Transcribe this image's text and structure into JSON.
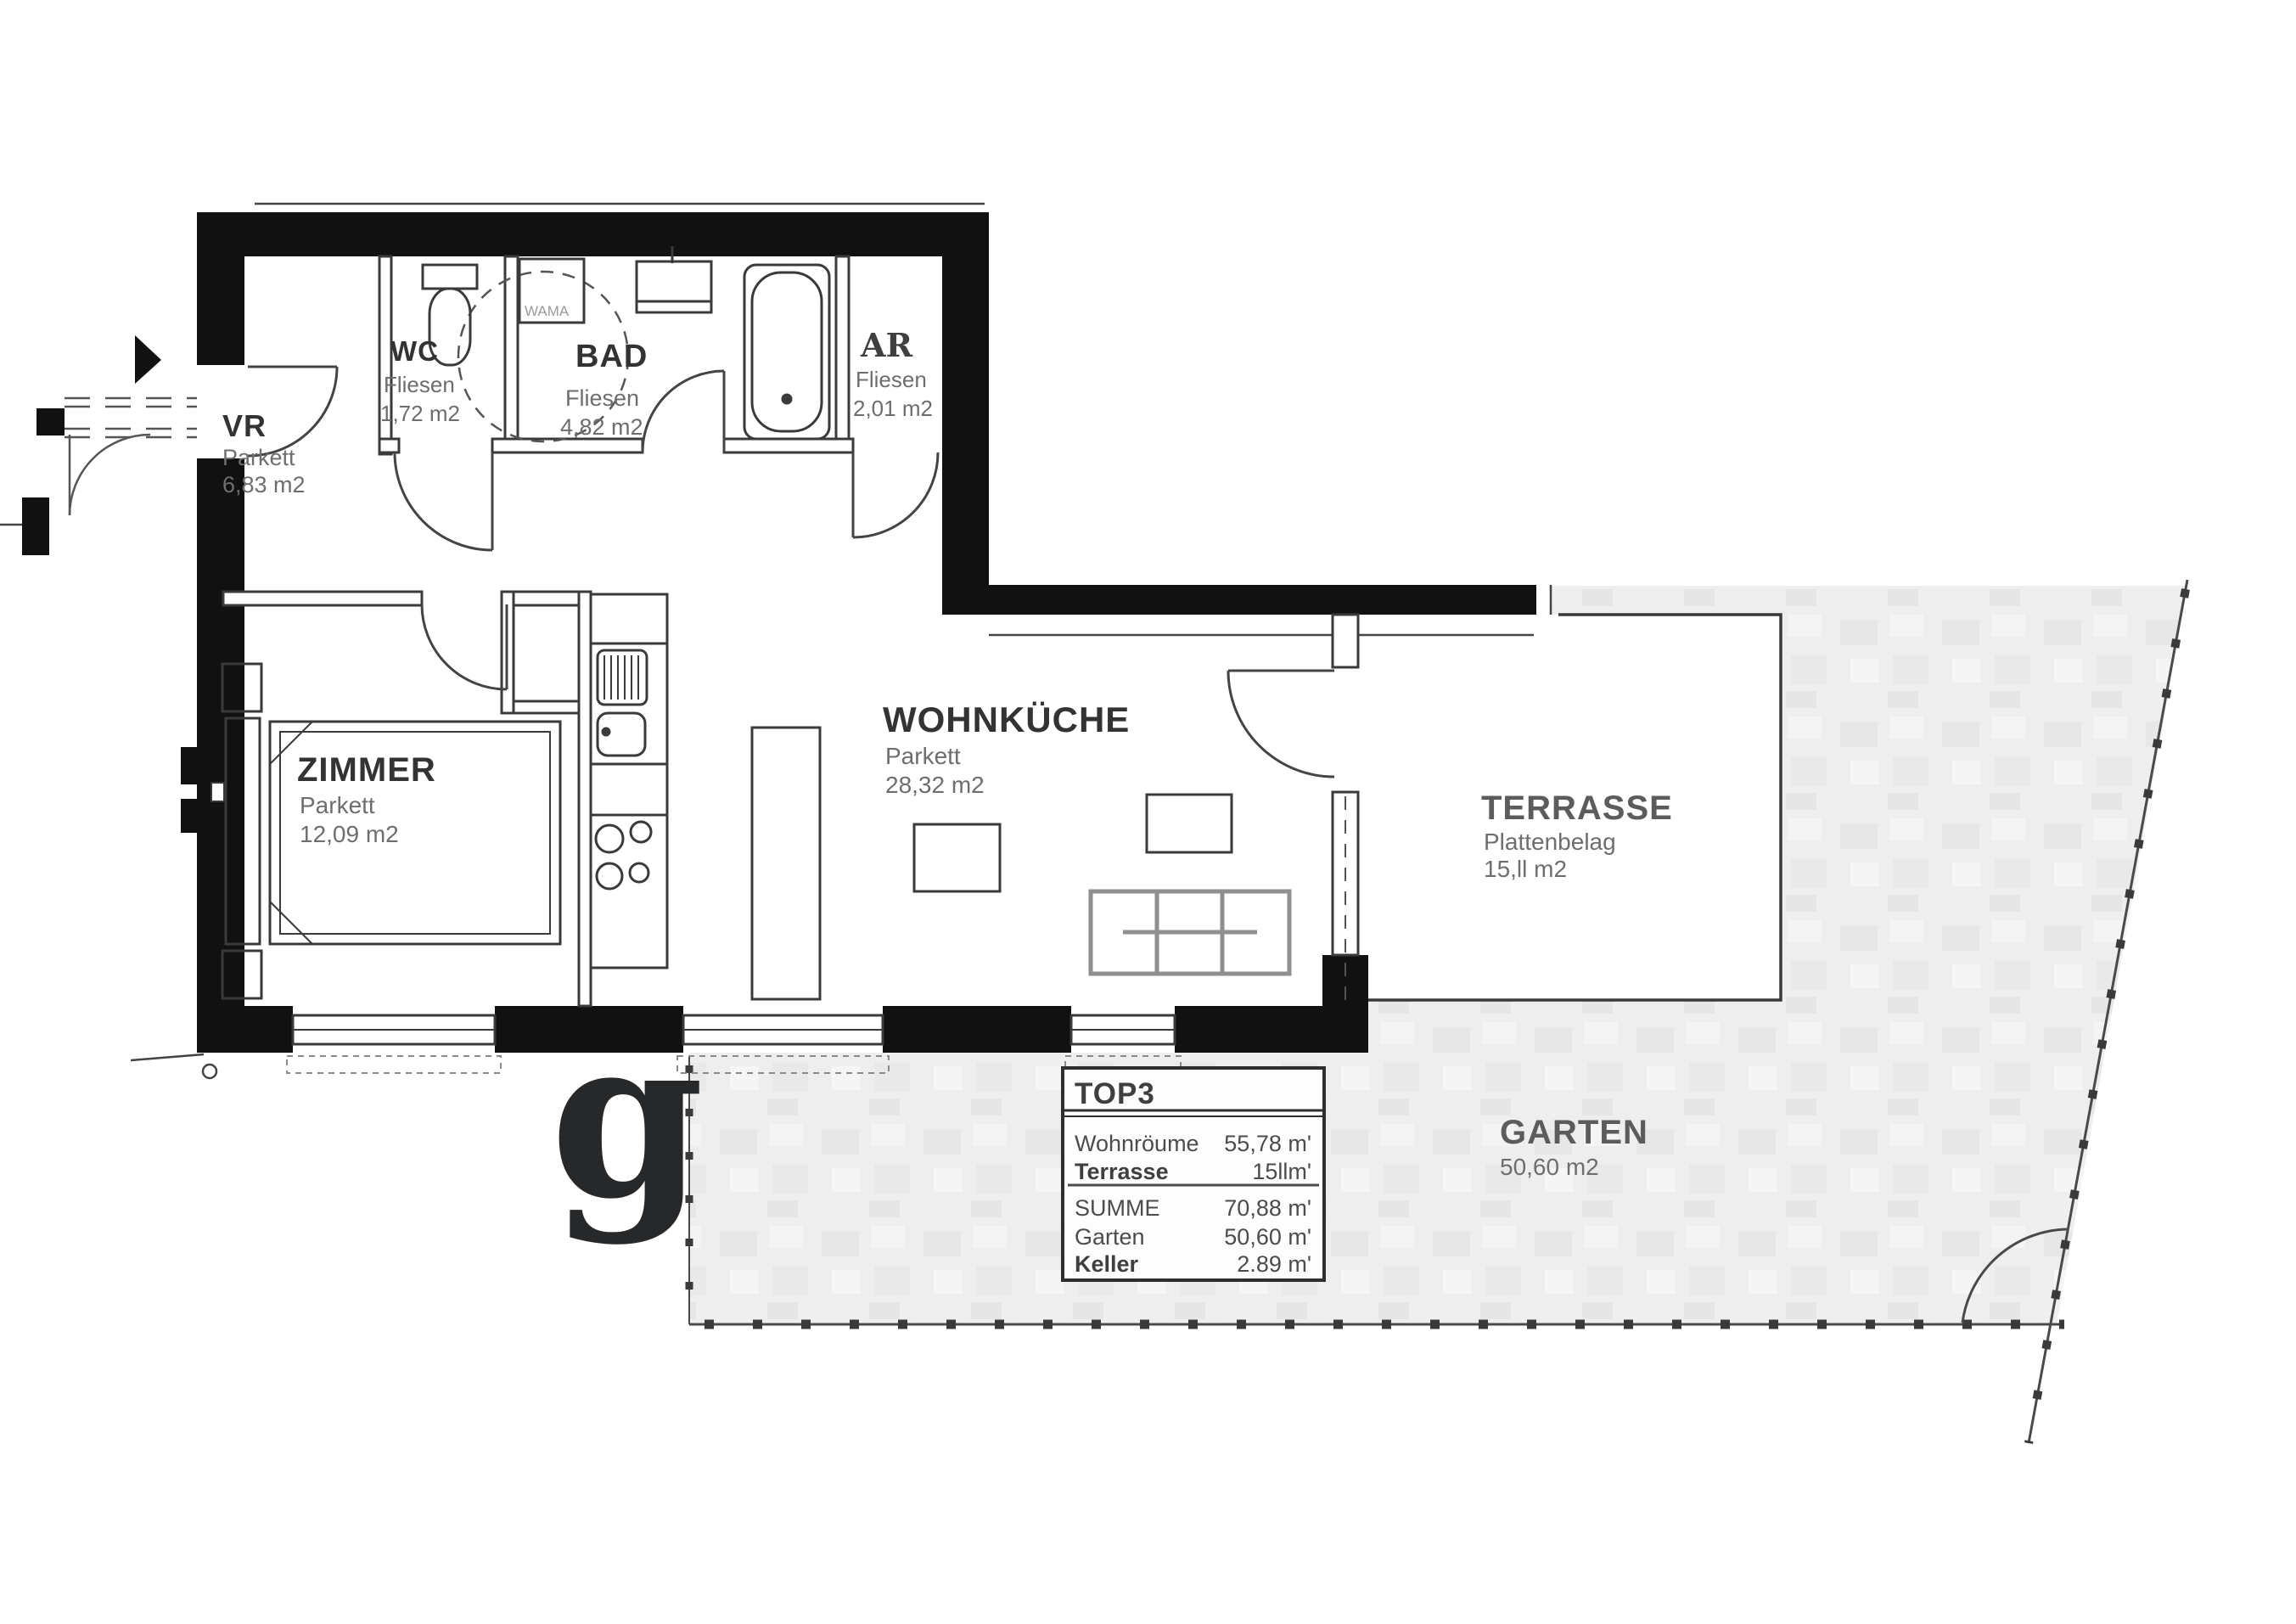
{
  "document": {
    "type": "floor-plan",
    "unit_label": "TOP3",
    "watermark": "g"
  },
  "rooms": [
    {
      "name": "WC",
      "floor": "Fliesen",
      "area": "1,72 m2"
    },
    {
      "name": "BAD",
      "floor": "Fliesen",
      "area": "4,82 m2"
    },
    {
      "name": "AR",
      "floor": "Fliesen",
      "area": "2,01 m2"
    },
    {
      "name": "VR",
      "floor": "Parkett",
      "area": "6,83 m2"
    },
    {
      "name": "ZIMMER",
      "floor": "Parkett",
      "area": "12,09 m2"
    },
    {
      "name": "WOHNKÜCHE",
      "floor": "Parkett",
      "area": "28,32 m2"
    },
    {
      "name": "TERRASSE",
      "floor": "Plattenbelag",
      "area": "15,ll m2"
    },
    {
      "name": "GARTEN",
      "floor": "",
      "area": "50,60 m2"
    }
  ],
  "fixtures": {
    "washing_machine_label": "WAMA"
  },
  "summary_table": {
    "title": "TOP3",
    "rows": [
      {
        "label": "Wohnröume",
        "value": "55,78 m'"
      },
      {
        "label": "Terrasse",
        "value": "15llm'"
      },
      {
        "label": "SUMME",
        "value": "70,88 m'"
      },
      {
        "label": "Garten",
        "value": "50,60 m'"
      },
      {
        "label": "Keller",
        "value": "2.89 m'"
      }
    ]
  },
  "colors": {
    "wall": "#111111",
    "thin_line": "#3a3a3a",
    "label_title": "#333333",
    "label_sub": "#6e6e6e",
    "garden_fill": "#ededed",
    "boundary": "#4a4a4a",
    "sofa": "#8f8f8f",
    "watermark": "#26282a",
    "table_text": "#4c4c4c"
  }
}
